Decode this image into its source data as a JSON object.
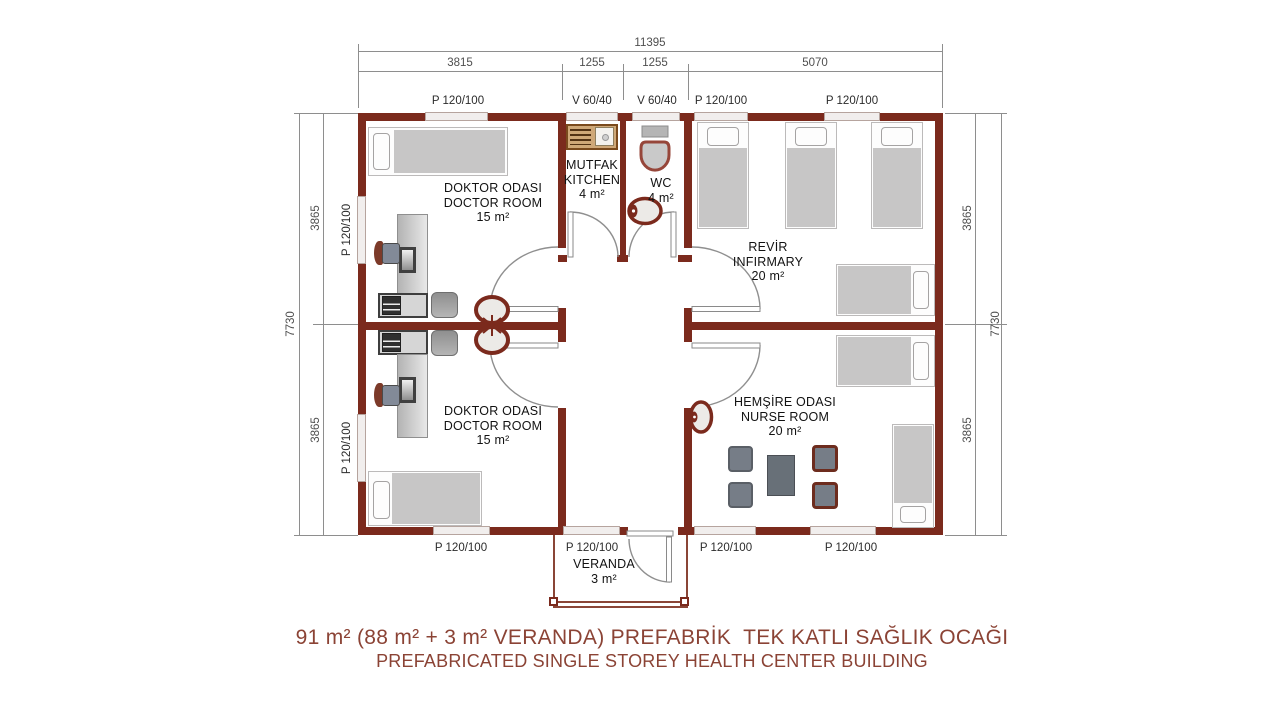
{
  "title": {
    "line1": "91 m² (88 m² + 3 m² VERANDA) PREFABRİK  TEK KATLI SAĞLIK OCAĞI",
    "line2": "PREFABRICATED SINGLE STOREY HEALTH CENTER BUILDING"
  },
  "dims": {
    "top_total": "11395",
    "top_segments": [
      "3815",
      "1255",
      "1255",
      "5070"
    ],
    "left_total": "7730",
    "left_segments": [
      "3865",
      "3865"
    ],
    "right_total": "7730",
    "right_segments": [
      "3865",
      "3865"
    ]
  },
  "openings": {
    "top_labels": [
      "P 120/100",
      "V 60/40",
      "V 60/40",
      "P 120/100",
      "P 120/100"
    ],
    "bottom_labels": [
      "P 120/100",
      "P 120/100",
      "P 120/100",
      "P 120/100"
    ],
    "left_labels": [
      "P 120/100",
      "P 120/100"
    ]
  },
  "rooms": {
    "doctor_top": {
      "title": "DOKTOR ODASI",
      "subtitle": "DOCTOR ROOM",
      "area": "15 m²"
    },
    "doctor_bottom": {
      "title": "DOKTOR ODASI",
      "subtitle": "DOCTOR ROOM",
      "area": "15 m²"
    },
    "kitchen": {
      "title": "MUTFAK",
      "subtitle": "KITCHEN",
      "area": "4 m²"
    },
    "wc": {
      "title": "WC",
      "area": "4 m²"
    },
    "infirmary": {
      "title": "REVİR",
      "subtitle": "INFIRMARY",
      "area": "20 m²"
    },
    "nurse": {
      "title": "HEMŞİRE ODASI",
      "subtitle": "NURSE ROOM",
      "area": "20 m²"
    },
    "veranda": {
      "title": "VERANDA",
      "area": "3 m²"
    }
  },
  "colors": {
    "wall": "#7b2a1d",
    "title_text": "#8b4335",
    "dimension_text": "#4f4f4f",
    "furniture_gray": "#c7c6c6",
    "kitchen_counter": "#cfa878"
  }
}
